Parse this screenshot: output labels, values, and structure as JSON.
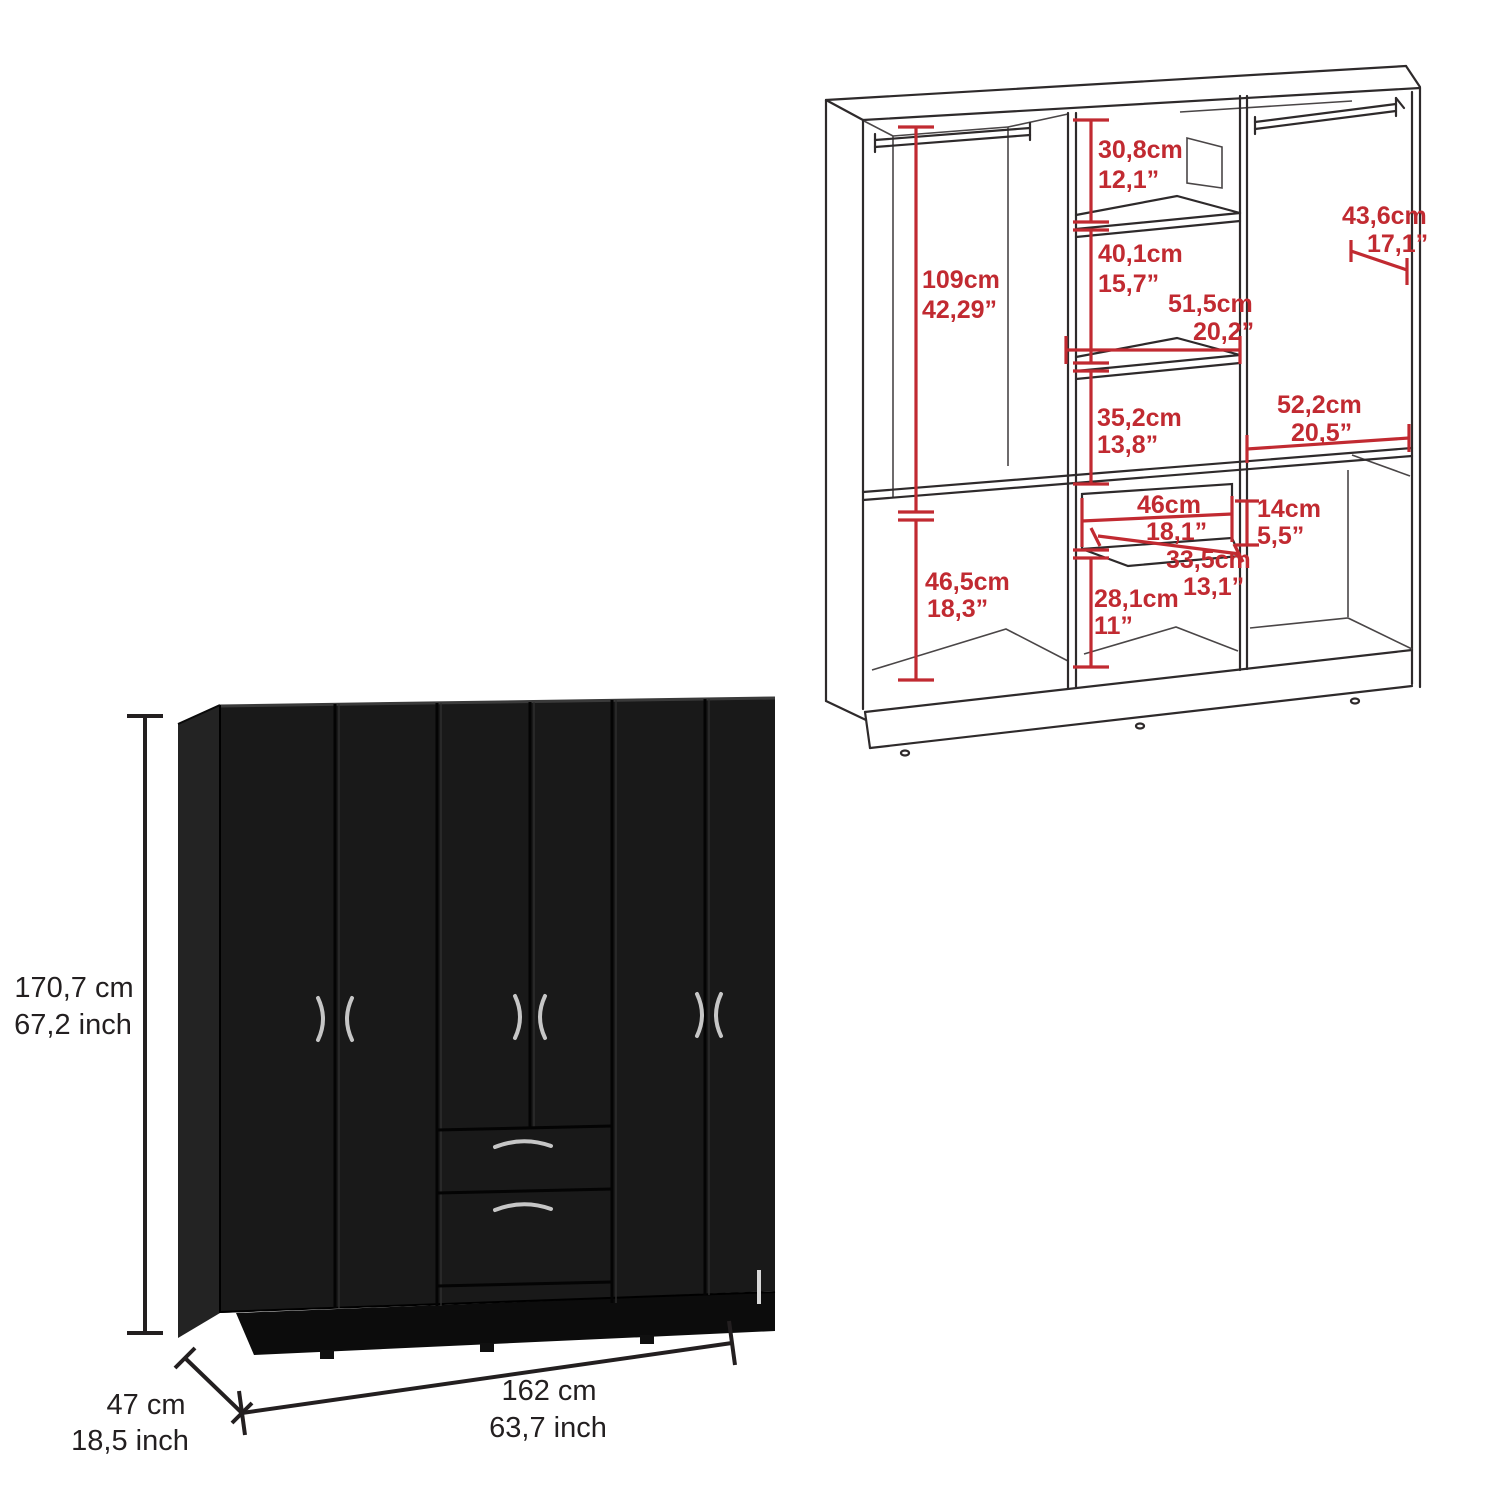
{
  "page": {
    "background": "#ffffff",
    "description": "Wardrobe product dimension sheet"
  },
  "colors": {
    "dimension_red": "#c12a31",
    "line_black": "#231f20",
    "wireframe_gray": "#2e2a2b",
    "wardrobe_front": "#191919",
    "wardrobe_side": "#232323",
    "handle_silver": "#c6c6c6"
  },
  "wireframe_diagram": {
    "dimensions": {
      "left_hanging_height": {
        "cm": "109cm",
        "inch": "42,29”"
      },
      "top_shelf_gap": {
        "cm": "30,8cm",
        "inch": "12,1”"
      },
      "middle_shelf_gap": {
        "cm": "40,1cm",
        "inch": "15,7”"
      },
      "middle_shelf_width": {
        "cm": "51,5cm",
        "inch": "20,2”"
      },
      "right_section_width": {
        "cm": "43,6cm",
        "inch": "17,1”"
      },
      "lower_middle_gap": {
        "cm": "35,2cm",
        "inch": "13,8”"
      },
      "right_shelf_width": {
        "cm": "52,2cm",
        "inch": "20,5”"
      },
      "drawer_width": {
        "cm": "46cm",
        "inch": "18,1”"
      },
      "drawer_height": {
        "cm": "14cm",
        "inch": "5,5”"
      },
      "drawer_depth": {
        "cm": "33,5cm",
        "inch": "13,1”"
      },
      "bottom_left_cubby_height": {
        "cm": "46,5cm",
        "inch": "18,3”"
      },
      "bottom_middle_cubby_height": {
        "cm": "28,1cm",
        "inch": "11”"
      }
    }
  },
  "product_view": {
    "overall_height": {
      "cm": "170,7 cm",
      "inch": "67,2 inch"
    },
    "overall_depth": {
      "cm": "47 cm",
      "inch": "18,5 inch"
    },
    "overall_width": {
      "cm": "162 cm",
      "inch": "63,7 inch"
    }
  }
}
